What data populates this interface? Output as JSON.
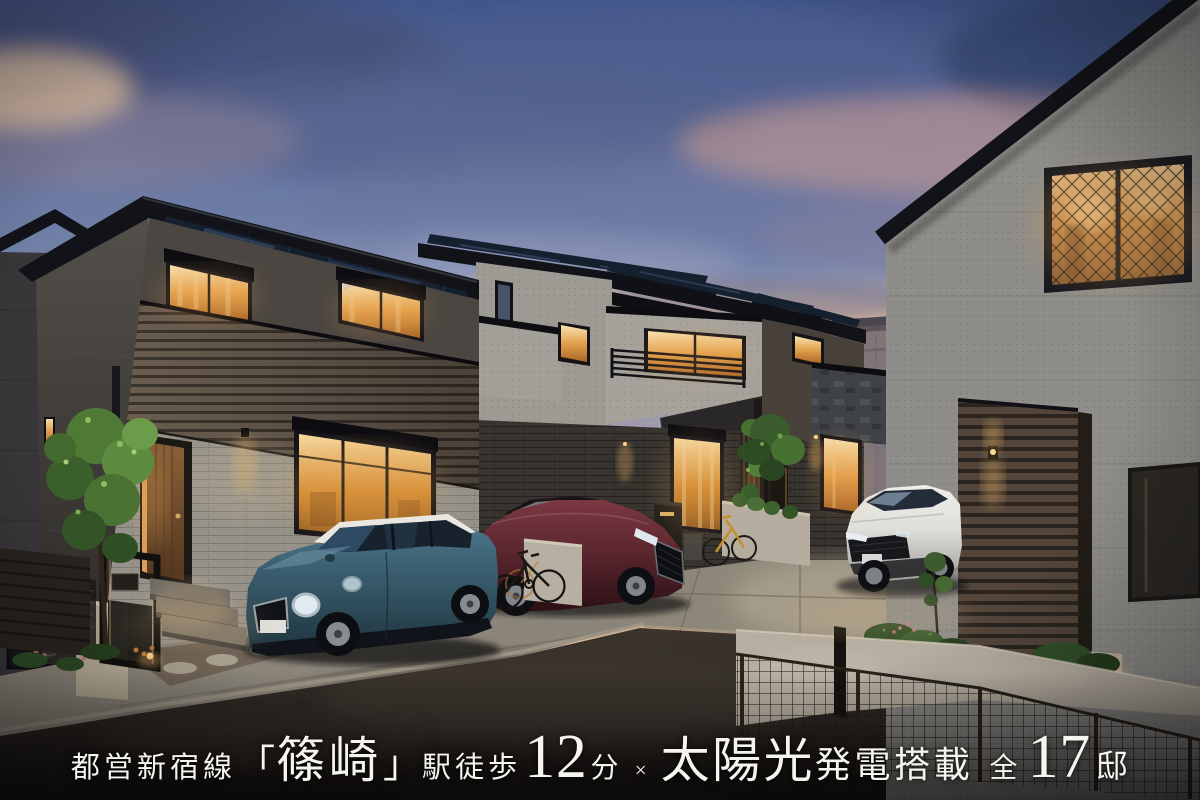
{
  "headline": {
    "full_text": "都営新宿線「篠崎」駅徒歩12分 × 太陽光発電搭載 全17邸",
    "segments": [
      {
        "text": "都営新宿線",
        "style": "kanji-md"
      },
      {
        "text": "「",
        "style": "bracket"
      },
      {
        "text": "篠崎",
        "style": "kanji-xl"
      },
      {
        "text": "」",
        "style": "bracket"
      },
      {
        "text": "駅徒歩",
        "style": "kanji-md"
      },
      {
        "text": "12",
        "style": "numeral"
      },
      {
        "text": "分",
        "style": "kanji-sm"
      },
      {
        "text": "×",
        "style": "multiply"
      },
      {
        "text": "太陽光",
        "style": "kanji-xl tight"
      },
      {
        "text": "発電搭載",
        "style": "kanji-md2"
      },
      {
        "text": "全",
        "style": "kanji-sm spaced"
      },
      {
        "text": "17",
        "style": "numeral"
      },
      {
        "text": "邸",
        "style": "kanji-sm2"
      }
    ]
  },
  "scene": {
    "setting": "dusk residential street with lit windows",
    "houses": [
      {
        "name": "far-left-house"
      },
      {
        "name": "left-house-solar-gable-roof-wood-slat-balcony"
      },
      {
        "name": "middle-house-balcony-solar-shed-roof"
      },
      {
        "name": "middle-right-house-stone-balcony"
      },
      {
        "name": "right-foreground-house-lattice-window-wood-porch"
      }
    ],
    "vehicles": [
      {
        "name": "teal-wagon-with-white-roof",
        "color": "#335463"
      },
      {
        "name": "burgundy-sedan",
        "color": "#5c272f"
      },
      {
        "name": "white-suv",
        "color": "#dfdedb"
      },
      {
        "name": "bicycle",
        "color": "#1a1815"
      }
    ]
  },
  "palette": {
    "sky_top": "#42578c",
    "sky_mid": "#7b8ab0",
    "sky_low": "#bfa49c",
    "sky_horizon": "#e8cba6",
    "cloud_slate": "#46527a",
    "cloud_pink": "#cf9f92",
    "cloud_cream": "#e9cdaa",
    "roof_black": "#121318",
    "solar_blue": "#15202e",
    "wall_dark": "#4b4641",
    "wall_taupe": "#474139",
    "wall_speckle": "#8e8d89",
    "brick_light": "#969289",
    "brick_dark": "#37342f",
    "wood_band": "#6a5d50",
    "wood_porch": "#53453a",
    "door_wood": "#7b5836",
    "glow_hi": "#f8e2b0",
    "glow_mid": "#e2a04c",
    "glow_deep": "#a86526",
    "concrete": "#8a8479",
    "concrete_bright": "#b6aea1",
    "gravel": "#6f6355",
    "road": "#2b2622",
    "road_deep": "#141110",
    "green_dark": "#2c4a24",
    "green_mid": "#47712f",
    "green_light": "#7fae54",
    "car_teal": "#335463",
    "car_roof": "#e9e7e0",
    "car_burgundy": "#5c272f",
    "car_white": "#dfdedb",
    "fence_metal": "#241f18",
    "distant_bldg": "#6e6a74",
    "text_color": "#f6f4ef"
  }
}
